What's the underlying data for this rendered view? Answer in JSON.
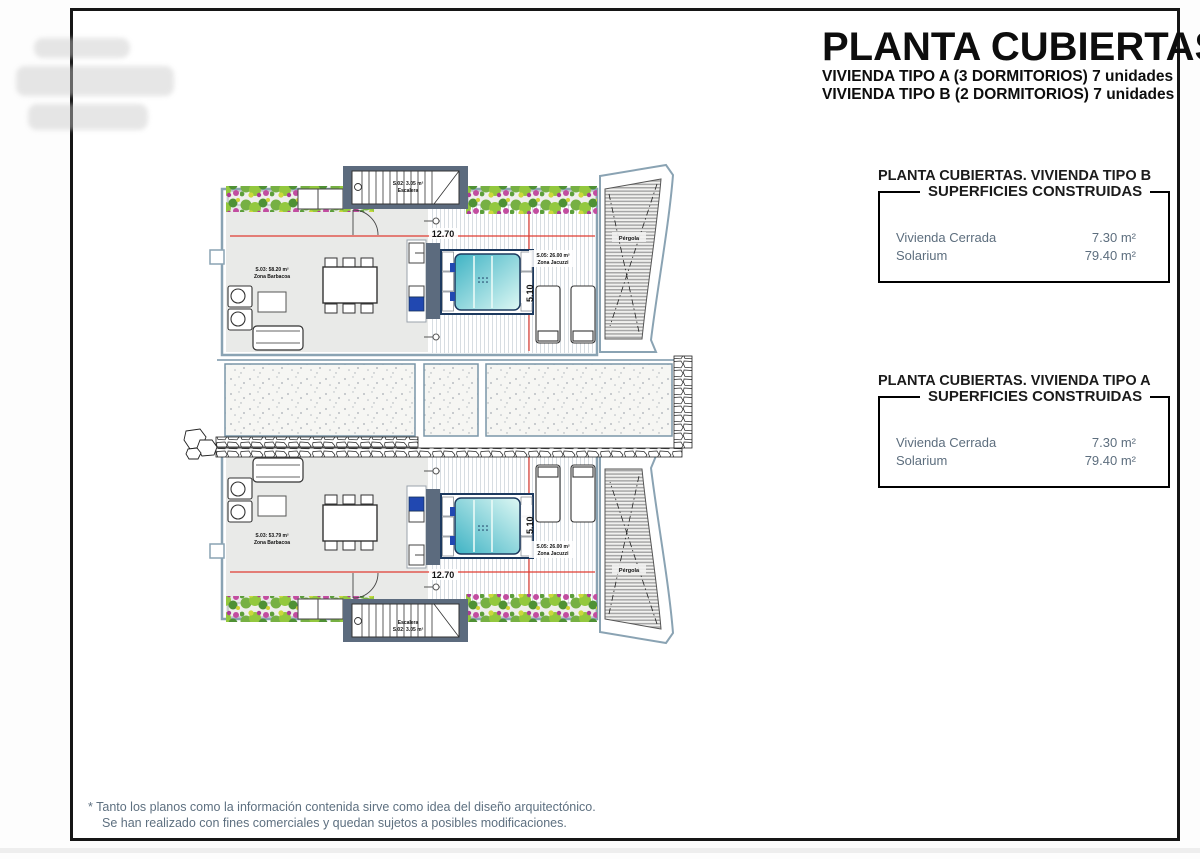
{
  "page": {
    "title": "PLANTA CUBIERTAS",
    "subtitle_a": "VIVIENDA TIPO A (3 DORMITORIOS) 7 unidades",
    "subtitle_b": "VIVIENDA TIPO B (2 DORMITORIOS) 7 unidades",
    "footer_line1": "* Tanto los planos como la información contenida sirve como idea del diseño arquitectónico.",
    "footer_line2": "Se han realizado con fines comerciales y quedan sujetos a posibles modificaciones."
  },
  "panels": [
    {
      "heading": "PLANTA CUBIERTAS. VIVIENDA TIPO B",
      "table_title": "SUPERFICIES CONSTRUIDAS",
      "rows": [
        {
          "label": "Vivienda Cerrada",
          "value": "7.30 m²"
        },
        {
          "label": "Solarium",
          "value": "79.40 m²"
        }
      ]
    },
    {
      "heading": "PLANTA CUBIERTAS. VIVIENDA TIPO A",
      "table_title": "SUPERFICIES CONSTRUIDAS",
      "rows": [
        {
          "label": "Vivienda Cerrada",
          "value": "7.30 m²"
        },
        {
          "label": "Solarium",
          "value": "79.40 m²"
        }
      ]
    }
  ],
  "plan": {
    "top": {
      "dim_w": "12.70",
      "dim_h": "5.10",
      "area1": "S.03: 58.20 m²",
      "area1_name": "Zona Barbacoa",
      "area2": "S.05: 26.00 m²",
      "area2_name": "Zona Jacuzzi",
      "stairs_area": "S.02: 3.05 m²",
      "stairs_name": "Escalera",
      "pergola": "Pérgola"
    },
    "bottom": {
      "dim_w": "12.70",
      "dim_h": "5.10",
      "area1": "S.03: 53.79 m²",
      "area1_name": "Zona Barbacoa",
      "area2": "S.05: 26.00 m²",
      "area2_name": "Zona Jacuzzi",
      "stairs_area": "S.02: 3.05 m²",
      "stairs_name": "Escalera",
      "pergola": "Pérgola"
    }
  },
  "colors": {
    "wall_blue": "#8aa3b3",
    "dark_slate": "#5c6b7e",
    "dim_red": "#e03c31",
    "pool_cyan": "#3fb3c4",
    "accent_blue": "#2148b1",
    "note_gray": "#5e7080"
  }
}
